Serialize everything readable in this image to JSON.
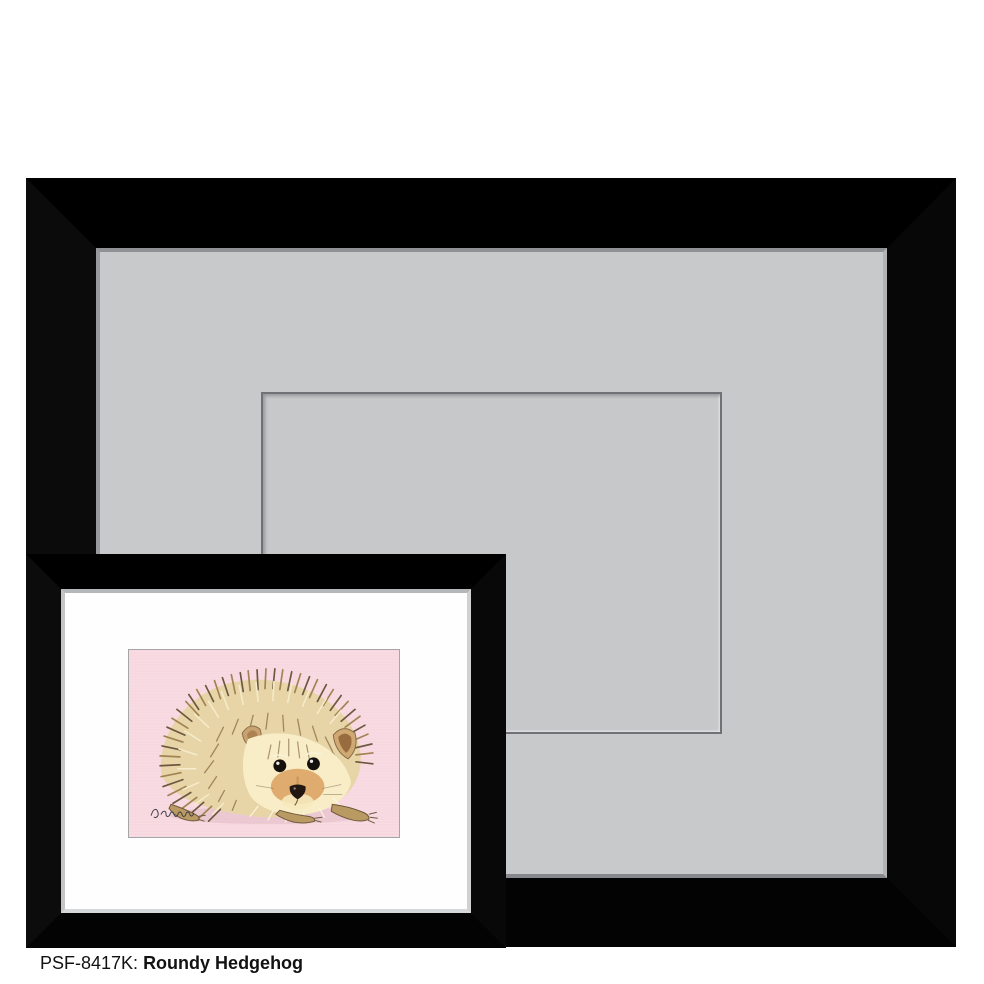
{
  "caption": {
    "sku": "PSF-8417K:",
    "title": "Roundy Hedgehog"
  },
  "artwork": {
    "subject": "hedgehog watercolor illustration",
    "background_color": "#f8d8e0",
    "signature_present": true
  },
  "colors": {
    "page_background": "#ffffff",
    "frame_black": "#000000",
    "large_mat_gray": "#c8c9cb",
    "mat_opening_line": "#707175",
    "small_mat_white": "#fefefe",
    "artwork_pink": "#f8d8e0",
    "caption_text": "#121212"
  }
}
